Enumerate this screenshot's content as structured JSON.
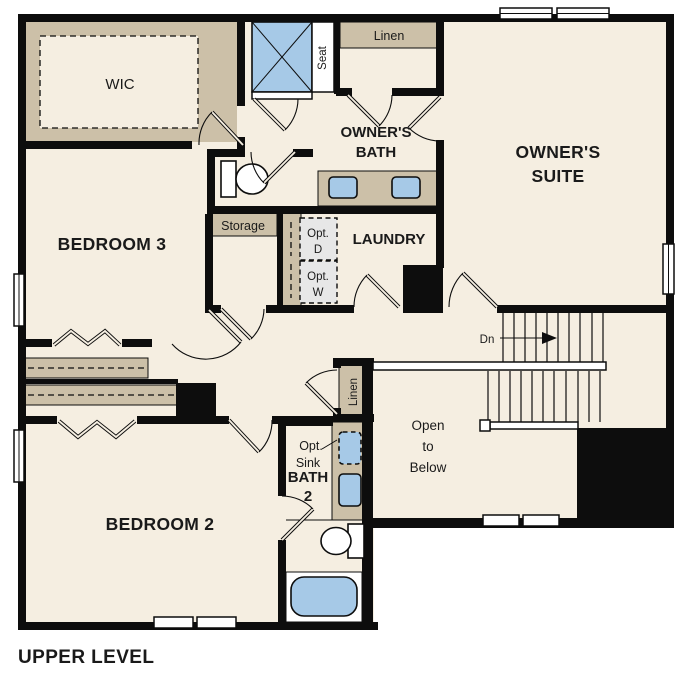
{
  "plan": {
    "title": "UPPER LEVEL",
    "rooms": {
      "wic": "WIC",
      "owners_bath": [
        "OWNER'S",
        "BATH"
      ],
      "owners_suite": [
        "OWNER'S",
        "SUITE"
      ],
      "bedroom3": "BEDROOM 3",
      "laundry": "LAUNDRY",
      "bedroom2": "BEDROOM 2",
      "bath2": [
        "BATH",
        "2"
      ]
    },
    "annotations": {
      "seat": "Seat",
      "linen_upper": "Linen",
      "linen_hall": "Linen",
      "storage": "Storage",
      "opt_dryer": [
        "Opt.",
        "D"
      ],
      "opt_washer": [
        "Opt.",
        "W"
      ],
      "opt_sink": [
        "Opt.",
        "Sink"
      ],
      "stairs_down": "Dn",
      "open_to_below": [
        "Open",
        "to",
        "Below"
      ]
    },
    "colors": {
      "wall": "#0d0d0d",
      "floor": "#f5eee1",
      "shelf_tan": "#ccc0a8",
      "fixture_blue": "#a6c9e7",
      "optional_gray": "#e7e7e7",
      "background": "#ffffff",
      "text": "#1a1a1a"
    }
  }
}
